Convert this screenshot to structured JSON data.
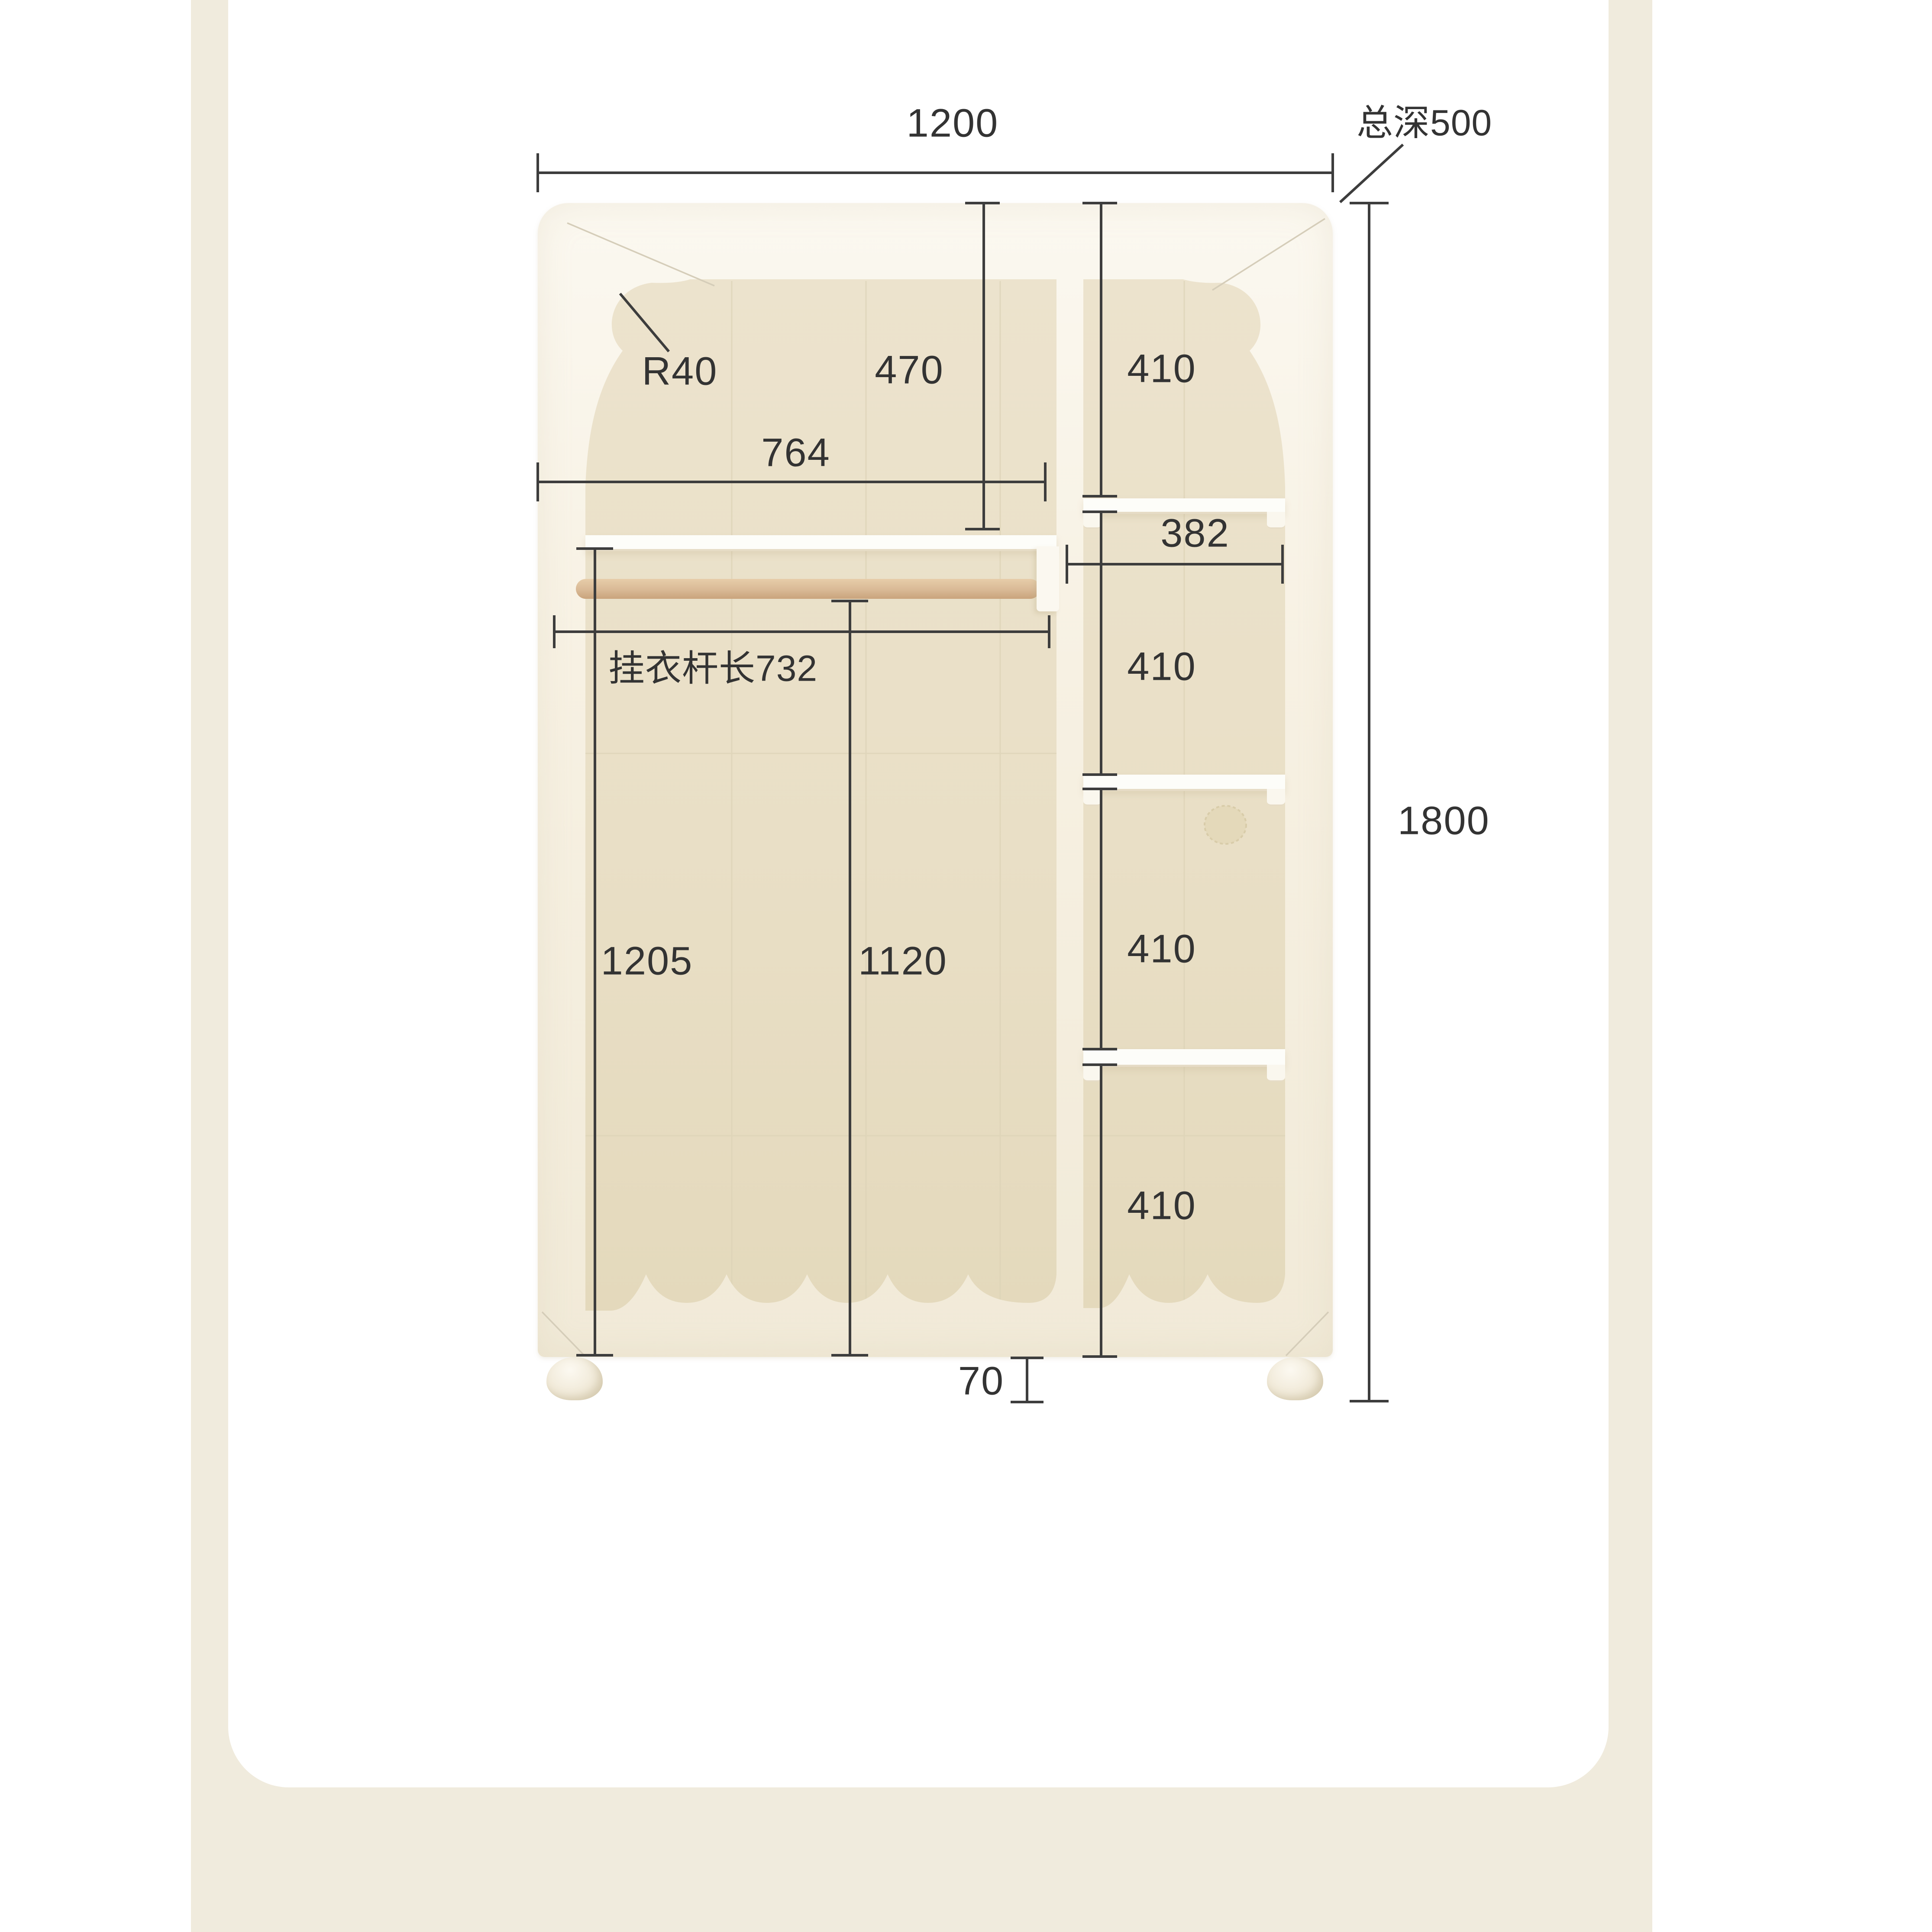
{
  "colors": {
    "page_bg": "#ffffff",
    "panel_bg": "#f0ebdd",
    "card_bg": "#ffffff",
    "dimension_line": "#3d3d3d",
    "label_text": "#333333",
    "cabinet_face": "#f8f3e7",
    "interior_wood": "#eae0c7",
    "rod_wood": "#d9b996",
    "shelf_white": "#fdfdf9"
  },
  "wardrobe": {
    "labels": {
      "overall_width": "1200",
      "overall_depth": "总深500",
      "overall_height": "1800",
      "ear_radius": "R40",
      "top_section_height": "470",
      "right_top_height": "410",
      "upper_inner_width": "764",
      "right_inner_width": "382",
      "rod_length": "挂衣杆长732",
      "left_inner_height": "1205",
      "rod_floor_height": "1120",
      "right_mid_height": "410",
      "right_lower_height": "410",
      "right_bottom_height": "410",
      "leg_height": "70"
    }
  }
}
